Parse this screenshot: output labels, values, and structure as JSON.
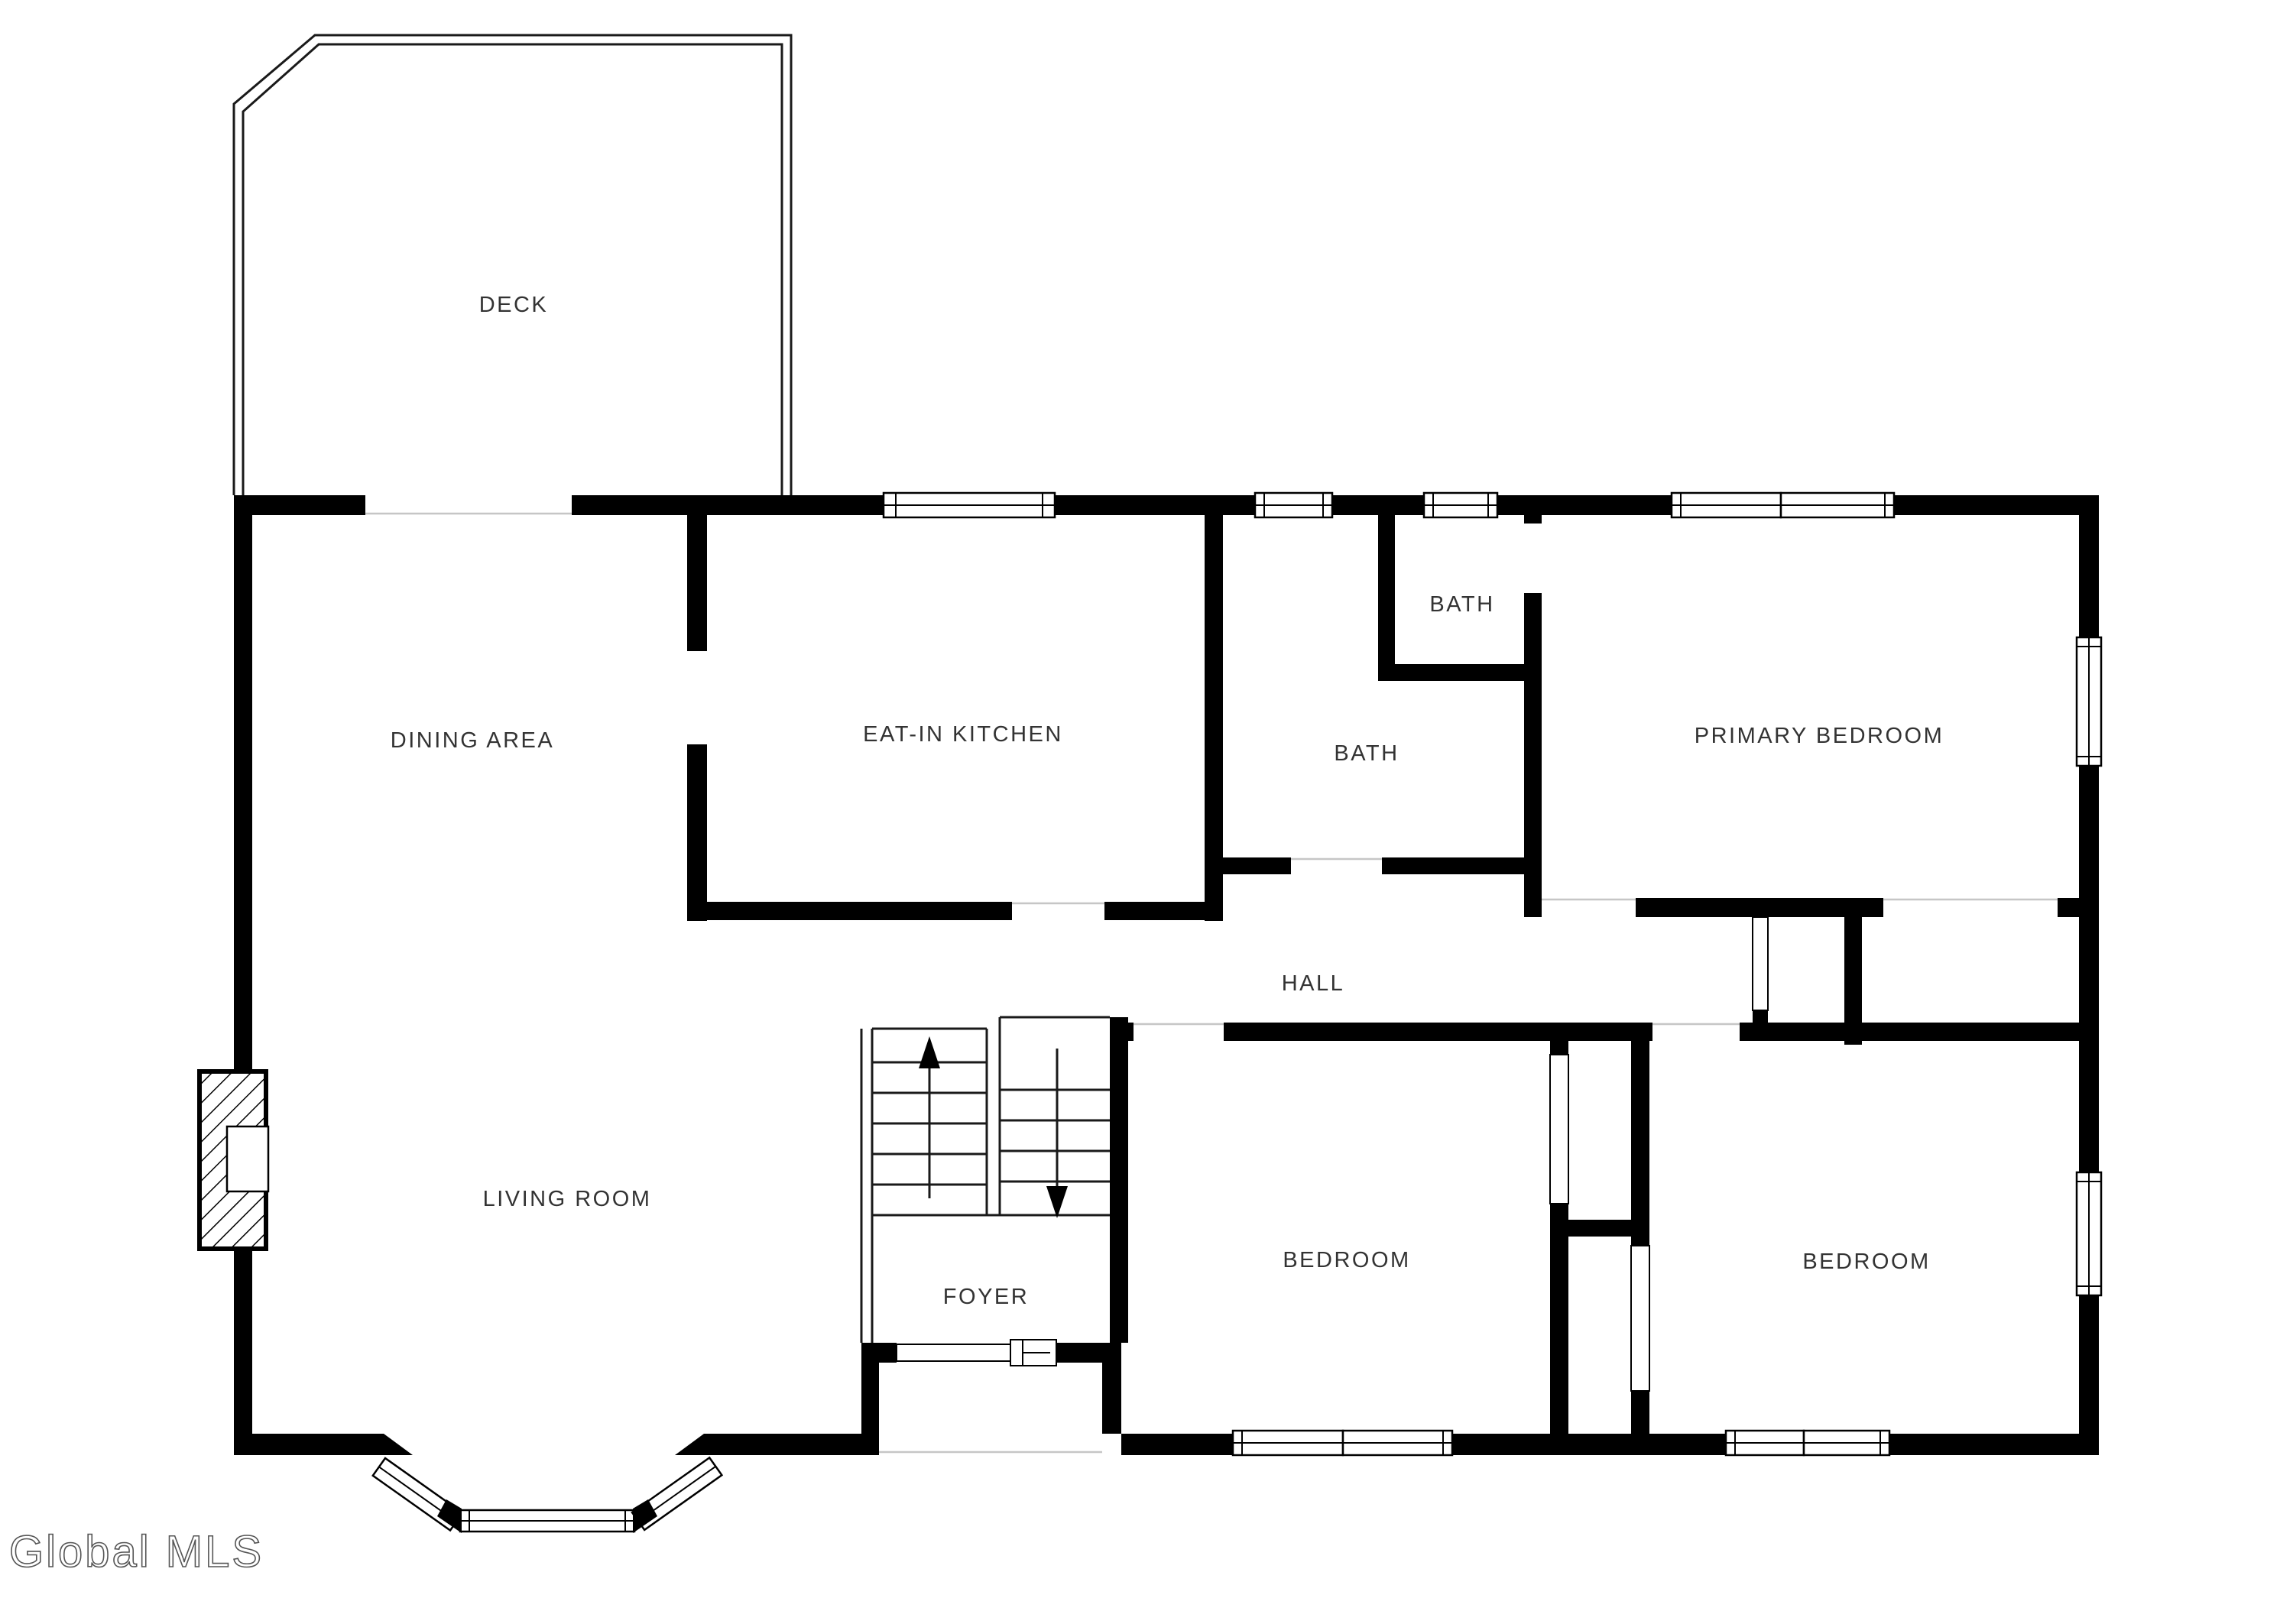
{
  "meta": {
    "type": "residential-floor-plan"
  },
  "colors": {
    "background": "#ffffff",
    "wall": "#000000",
    "label": "#333333",
    "watermark_stroke": "#555555"
  },
  "rooms": [
    {
      "id": "deck",
      "label": "DECK"
    },
    {
      "id": "dining-area",
      "label": "DINING AREA"
    },
    {
      "id": "eat-in-kitchen",
      "label": "EAT-IN KITCHEN"
    },
    {
      "id": "bath-upper",
      "label": "BATH"
    },
    {
      "id": "bath-lower",
      "label": "BATH"
    },
    {
      "id": "primary-bedroom",
      "label": "PRIMARY BEDROOM"
    },
    {
      "id": "hall",
      "label": "HALL"
    },
    {
      "id": "living-room",
      "label": "LIVING ROOM"
    },
    {
      "id": "foyer",
      "label": "FOYER"
    },
    {
      "id": "bedroom-center",
      "label": "BEDROOM"
    },
    {
      "id": "bedroom-right",
      "label": "BEDROOM"
    }
  ],
  "stairs": {
    "up_arrow": "▲",
    "down_arrow": "▼"
  },
  "watermark": {
    "text": "Global MLS"
  }
}
